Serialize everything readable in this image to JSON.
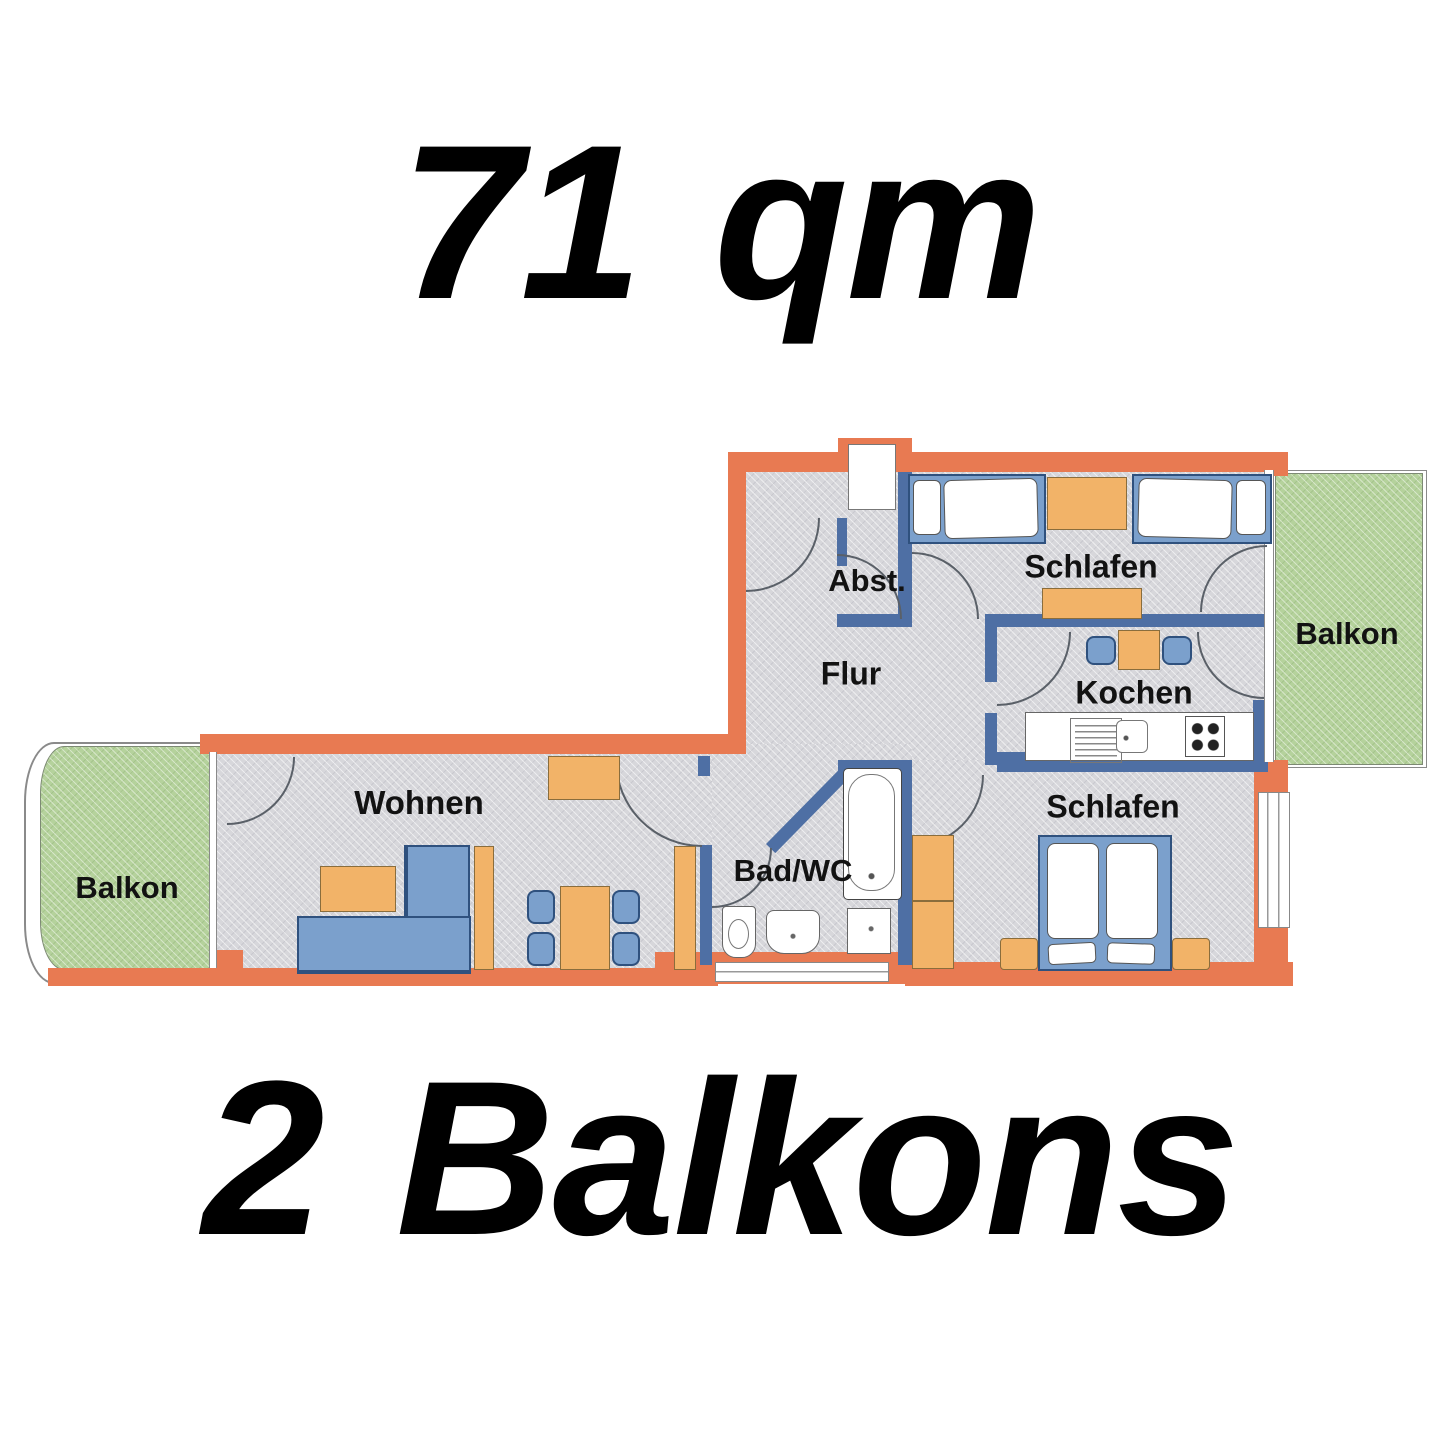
{
  "title": "71 qm",
  "subtitle": "2 Balkons",
  "plan": {
    "rooms": {
      "balkon_left": "Balkon",
      "wohnen": "Wohnen",
      "bad_wc": "Bad/WC",
      "flur": "Flur",
      "abstellraum": "Abst.",
      "schlafen_top": "Schlafen",
      "kochen": "Kochen",
      "schlafen_bottom": "Schlafen",
      "balkon_right": "Balkon"
    },
    "colors": {
      "exterior_wall": "#e87a52",
      "interior_wall": "#4e6fa4",
      "floor": "#d7d7db",
      "balcony": "#b5d29c",
      "furniture_wood": "#f2b368",
      "furniture_blue": "#7ba0cc"
    }
  }
}
